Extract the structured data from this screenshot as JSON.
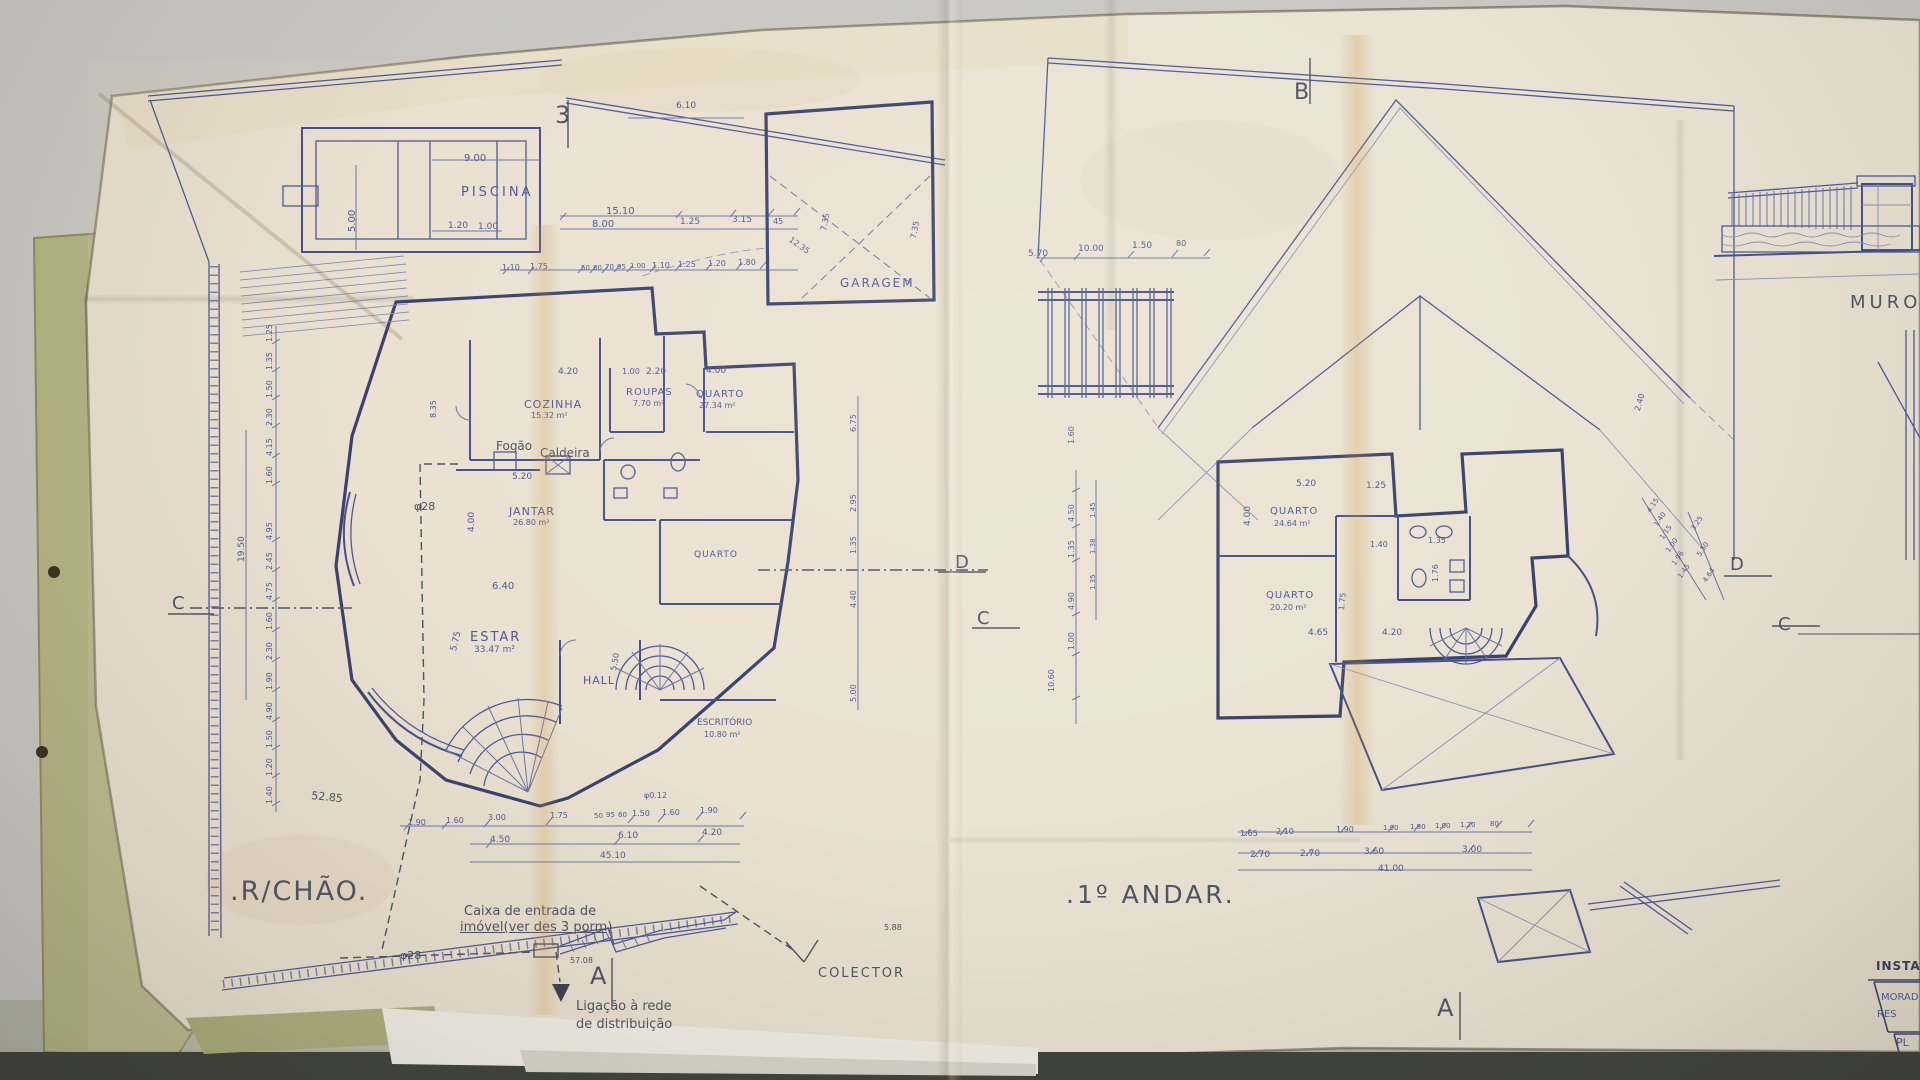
{
  "palette": {
    "desk": "#c9c8c3",
    "desk_low": "#b2b5a7",
    "shadow_band": "#3d4139",
    "paper": "#eae3d3",
    "fold_tan": "#c89137",
    "folder_green": "#b5b586",
    "ink": "#4d5a99",
    "ink_dark": "#39426f",
    "pencil": "#4e5366"
  },
  "left_plan": {
    "title": ".R/CHÃO."
  },
  "right_plan": {
    "title": ".1º ANDAR."
  },
  "labels": [
    {
      "n": "section-marker-3",
      "t": "3",
      "x": 555,
      "y": 103,
      "fs": 24,
      "cls": "pencil"
    },
    {
      "n": "piscina-label",
      "t": "PISCINA",
      "x": 461,
      "y": 186,
      "fs": 13,
      "ls": 3
    },
    {
      "t": "9.00",
      "x": 464,
      "y": 154,
      "fs": 10
    },
    {
      "t": "5.00",
      "x": 348,
      "y": 232,
      "fs": 10,
      "rot": -90
    },
    {
      "t": "1.20",
      "x": 448,
      "y": 222,
      "fs": 9
    },
    {
      "t": "1.00",
      "x": 478,
      "y": 223,
      "fs": 9
    },
    {
      "t": "15.10",
      "x": 606,
      "y": 207,
      "fs": 10
    },
    {
      "t": "8.00",
      "x": 592,
      "y": 220,
      "fs": 10
    },
    {
      "t": "1.25",
      "x": 680,
      "y": 218,
      "fs": 9
    },
    {
      "t": "3.15",
      "x": 732,
      "y": 216,
      "fs": 9
    },
    {
      "t": "45",
      "x": 773,
      "y": 218,
      "fs": 8
    },
    {
      "t": "6.10",
      "x": 676,
      "y": 102,
      "fs": 9
    },
    {
      "t": "1.10",
      "x": 502,
      "y": 264,
      "fs": 8
    },
    {
      "t": "1.75",
      "x": 530,
      "y": 263,
      "fs": 8
    },
    {
      "t": "50",
      "x": 581,
      "y": 265,
      "fs": 7
    },
    {
      "t": "80",
      "x": 593,
      "y": 265,
      "fs": 7
    },
    {
      "t": "70",
      "x": 605,
      "y": 264,
      "fs": 7
    },
    {
      "t": "95",
      "x": 617,
      "y": 264,
      "fs": 7
    },
    {
      "t": "1.00",
      "x": 630,
      "y": 263,
      "fs": 7
    },
    {
      "t": "1.10",
      "x": 652,
      "y": 262,
      "fs": 8
    },
    {
      "t": "1.25",
      "x": 678,
      "y": 261,
      "fs": 8
    },
    {
      "t": "1.20",
      "x": 708,
      "y": 260,
      "fs": 8
    },
    {
      "t": "1.80",
      "x": 738,
      "y": 259,
      "fs": 8
    },
    {
      "t": "12.35",
      "x": 792,
      "y": 236,
      "fs": 8,
      "rot": 35
    },
    {
      "t": "7.35",
      "x": 820,
      "y": 230,
      "fs": 8,
      "rot": -78
    },
    {
      "t": "7.35",
      "x": 910,
      "y": 238,
      "fs": 8,
      "rot": -80
    },
    {
      "n": "garagem-label",
      "t": "GARAGEM",
      "x": 840,
      "y": 277,
      "fs": 12,
      "ls": 2
    },
    {
      "t": "4.20",
      "x": 558,
      "y": 368,
      "fs": 9
    },
    {
      "t": "1.00",
      "x": 622,
      "y": 368,
      "fs": 8
    },
    {
      "t": "2.20",
      "x": 646,
      "y": 368,
      "fs": 9
    },
    {
      "t": "4.00",
      "x": 706,
      "y": 367,
      "fs": 9
    },
    {
      "n": "cozinha-label",
      "t": "COZINHA",
      "x": 524,
      "y": 399,
      "fs": 11,
      "ls": 1
    },
    {
      "n": "room-area",
      "t": "15.32 m²",
      "x": 531,
      "y": 412,
      "fs": 8
    },
    {
      "t": "8.35",
      "x": 430,
      "y": 418,
      "fs": 8,
      "rot": -90
    },
    {
      "n": "roupas-label",
      "t": "ROUPAS",
      "x": 626,
      "y": 388,
      "fs": 10,
      "ls": 1
    },
    {
      "n": "room-area",
      "t": "7.70 m²",
      "x": 633,
      "y": 400,
      "fs": 8
    },
    {
      "n": "quarto-label",
      "t": "QUARTO",
      "x": 696,
      "y": 390,
      "fs": 10,
      "ls": 1
    },
    {
      "n": "room-area",
      "t": "27.34 m²",
      "x": 699,
      "y": 402,
      "fs": 8
    },
    {
      "n": "fogao-label",
      "t": "Fogão",
      "x": 496,
      "y": 440,
      "fs": 12,
      "cls": "pencil"
    },
    {
      "n": "caldeira-label",
      "t": "Caldeira",
      "x": 540,
      "y": 447,
      "fs": 12,
      "cls": "pencil"
    },
    {
      "n": "phi28-label",
      "t": "φ28",
      "x": 414,
      "y": 501,
      "fs": 11,
      "cls": "pencil"
    },
    {
      "n": "jantar-label",
      "t": "JANTAR",
      "x": 509,
      "y": 506,
      "fs": 11,
      "ls": 1
    },
    {
      "n": "room-area",
      "t": "26.80 m²",
      "x": 513,
      "y": 519,
      "fs": 8
    },
    {
      "t": "5.20",
      "x": 512,
      "y": 473,
      "fs": 9
    },
    {
      "t": "4.00",
      "x": 468,
      "y": 532,
      "fs": 9,
      "rot": -90
    },
    {
      "n": "quarto2-label",
      "t": "QUARTO",
      "x": 694,
      "y": 551,
      "fs": 9,
      "ls": 1
    },
    {
      "t": "6.40",
      "x": 492,
      "y": 582,
      "fs": 10
    },
    {
      "n": "estar-label",
      "t": "ESTAR",
      "x": 470,
      "y": 631,
      "fs": 13,
      "ls": 2
    },
    {
      "n": "room-area",
      "t": "33.47 m²",
      "x": 474,
      "y": 646,
      "fs": 9
    },
    {
      "t": "5.75",
      "x": 450,
      "y": 650,
      "fs": 9,
      "rot": -76
    },
    {
      "t": "5.50",
      "x": 610,
      "y": 670,
      "fs": 8,
      "rot": -80
    },
    {
      "n": "hall-label",
      "t": "HALL",
      "x": 583,
      "y": 675,
      "fs": 11,
      "ls": 1
    },
    {
      "n": "escritorio-label",
      "t": "ESCRITÓRIO",
      "x": 697,
      "y": 719,
      "fs": 9
    },
    {
      "n": "room-area",
      "t": "10.80 m²",
      "x": 704,
      "y": 731,
      "fs": 8
    },
    {
      "t": "1.25",
      "x": 266,
      "y": 342,
      "fs": 8,
      "rot": -90
    },
    {
      "t": "1.35",
      "x": 266,
      "y": 370,
      "fs": 8,
      "rot": -90
    },
    {
      "t": "1.50",
      "x": 266,
      "y": 398,
      "fs": 8,
      "rot": -90
    },
    {
      "t": "2.30",
      "x": 266,
      "y": 426,
      "fs": 8,
      "rot": -90
    },
    {
      "t": "4.15",
      "x": 266,
      "y": 456,
      "fs": 8,
      "rot": -90
    },
    {
      "t": "1.60",
      "x": 266,
      "y": 484,
      "fs": 8,
      "rot": -90
    },
    {
      "t": "4.95",
      "x": 266,
      "y": 540,
      "fs": 8,
      "rot": -90
    },
    {
      "t": "2.45",
      "x": 266,
      "y": 570,
      "fs": 8,
      "rot": -90
    },
    {
      "t": "4.75",
      "x": 266,
      "y": 600,
      "fs": 8,
      "rot": -90
    },
    {
      "t": "1.60",
      "x": 266,
      "y": 630,
      "fs": 8,
      "rot": -90
    },
    {
      "t": "2.30",
      "x": 266,
      "y": 660,
      "fs": 8,
      "rot": -90
    },
    {
      "t": "1.90",
      "x": 266,
      "y": 690,
      "fs": 8,
      "rot": -90
    },
    {
      "t": "4.90",
      "x": 266,
      "y": 720,
      "fs": 8,
      "rot": -90
    },
    {
      "t": "1.50",
      "x": 266,
      "y": 748,
      "fs": 8,
      "rot": -90
    },
    {
      "t": "1.20",
      "x": 266,
      "y": 776,
      "fs": 8,
      "rot": -90
    },
    {
      "t": "1.40",
      "x": 266,
      "y": 804,
      "fs": 8,
      "rot": -90
    },
    {
      "t": "19.50",
      "x": 238,
      "y": 562,
      "fs": 9,
      "rot": -90
    },
    {
      "t": "6.75",
      "x": 850,
      "y": 432,
      "fs": 8,
      "rot": -90
    },
    {
      "t": "2.95",
      "x": 850,
      "y": 512,
      "fs": 8,
      "rot": -90
    },
    {
      "t": "1.35",
      "x": 850,
      "y": 554,
      "fs": 8,
      "rot": -90
    },
    {
      "t": "4.40",
      "x": 850,
      "y": 608,
      "fs": 8,
      "rot": -90
    },
    {
      "t": "5.00",
      "x": 850,
      "y": 702,
      "fs": 8,
      "rot": -90
    },
    {
      "t": "52.85",
      "x": 312,
      "y": 790,
      "fs": 11,
      "rot": 6,
      "cls": "pencil"
    },
    {
      "t": "1.90",
      "x": 408,
      "y": 819,
      "fs": 8
    },
    {
      "t": "1.60",
      "x": 446,
      "y": 817,
      "fs": 8
    },
    {
      "t": "3.00",
      "x": 488,
      "y": 814,
      "fs": 8
    },
    {
      "t": "1.75",
      "x": 550,
      "y": 812,
      "fs": 8
    },
    {
      "t": "50",
      "x": 594,
      "y": 813,
      "fs": 7
    },
    {
      "t": "95",
      "x": 606,
      "y": 812,
      "fs": 7
    },
    {
      "t": "60",
      "x": 618,
      "y": 812,
      "fs": 7
    },
    {
      "t": "1.50",
      "x": 632,
      "y": 810,
      "fs": 8
    },
    {
      "t": "1.60",
      "x": 662,
      "y": 809,
      "fs": 8
    },
    {
      "t": "1.90",
      "x": 700,
      "y": 807,
      "fs": 8
    },
    {
      "t": "4.50",
      "x": 490,
      "y": 836,
      "fs": 9
    },
    {
      "t": "6.10",
      "x": 618,
      "y": 832,
      "fs": 9
    },
    {
      "t": "4.20",
      "x": 702,
      "y": 829,
      "fs": 9
    },
    {
      "t": "45.10",
      "x": 600,
      "y": 852,
      "fs": 9
    },
    {
      "t": "φ0.12",
      "x": 644,
      "y": 792,
      "fs": 8
    },
    {
      "n": "caixa-note-line1",
      "t": "Caixa de entrada de",
      "x": 464,
      "y": 905,
      "fs": 13,
      "cls": "pencil"
    },
    {
      "n": "caixa-note-line2",
      "t": "imóvel(ver des 3 porm)",
      "x": 460,
      "y": 921,
      "fs": 13,
      "cls": "pencil",
      "u": 1
    },
    {
      "n": "phi28-label",
      "t": "φ28",
      "x": 400,
      "y": 950,
      "fs": 11,
      "cls": "pencil"
    },
    {
      "t": "57.08",
      "x": 570,
      "y": 957,
      "fs": 8,
      "cls": "pencil"
    },
    {
      "n": "section-marker-A",
      "t": "A",
      "x": 590,
      "y": 964,
      "fs": 24,
      "cls": "pencil"
    },
    {
      "n": "ligacao-note-line1",
      "t": "Ligação à rede",
      "x": 576,
      "y": 1000,
      "fs": 13,
      "cls": "pencil"
    },
    {
      "n": "ligacao-note-line2",
      "t": "de distribuição",
      "x": 576,
      "y": 1018,
      "fs": 13,
      "cls": "pencil"
    },
    {
      "n": "colector-label",
      "t": "COLECTOR",
      "x": 818,
      "y": 967,
      "fs": 13,
      "ls": 2,
      "cls": "pencil"
    },
    {
      "t": "5.88",
      "x": 884,
      "y": 924,
      "fs": 8,
      "cls": "pencil"
    },
    {
      "n": "section-marker-C",
      "t": "C",
      "x": 172,
      "y": 595,
      "fs": 18,
      "cls": "pencil"
    },
    {
      "n": "section-marker-D",
      "t": "D",
      "x": 955,
      "y": 554,
      "fs": 18,
      "cls": "pencil"
    },
    {
      "n": "section-marker-B",
      "t": "B",
      "x": 1294,
      "y": 82,
      "fs": 22,
      "cls": "pencil"
    },
    {
      "t": "5.70",
      "x": 1028,
      "y": 250,
      "fs": 9
    },
    {
      "t": "10.00",
      "x": 1078,
      "y": 245,
      "fs": 9
    },
    {
      "t": "1.50",
      "x": 1132,
      "y": 242,
      "fs": 9
    },
    {
      "t": "80",
      "x": 1176,
      "y": 240,
      "fs": 8
    },
    {
      "t": "1.60",
      "x": 1068,
      "y": 444,
      "fs": 8,
      "rot": -90
    },
    {
      "t": "4.50",
      "x": 1068,
      "y": 522,
      "fs": 8,
      "rot": -90
    },
    {
      "t": "1.35",
      "x": 1068,
      "y": 558,
      "fs": 8,
      "rot": -90
    },
    {
      "t": "4.90",
      "x": 1068,
      "y": 610,
      "fs": 8,
      "rot": -90
    },
    {
      "t": "1.00",
      "x": 1068,
      "y": 650,
      "fs": 8,
      "rot": -90
    },
    {
      "t": "10.60",
      "x": 1048,
      "y": 692,
      "fs": 8,
      "rot": -90
    },
    {
      "t": "1.45",
      "x": 1090,
      "y": 518,
      "fs": 7,
      "rot": -90
    },
    {
      "t": "1.38",
      "x": 1090,
      "y": 554,
      "fs": 7,
      "rot": -90
    },
    {
      "t": "1.35",
      "x": 1090,
      "y": 590,
      "fs": 7,
      "rot": -90
    },
    {
      "t": "5.20",
      "x": 1296,
      "y": 480,
      "fs": 9
    },
    {
      "t": "1.25",
      "x": 1366,
      "y": 482,
      "fs": 9
    },
    {
      "t": "4.00",
      "x": 1244,
      "y": 526,
      "fs": 9,
      "rot": -90
    },
    {
      "n": "quarto-label",
      "t": "QUARTO",
      "x": 1270,
      "y": 507,
      "fs": 10,
      "ls": 1
    },
    {
      "n": "room-area",
      "t": "24.64 m²",
      "x": 1274,
      "y": 520,
      "fs": 8
    },
    {
      "t": "1.40",
      "x": 1370,
      "y": 541,
      "fs": 8
    },
    {
      "t": "1.35",
      "x": 1428,
      "y": 537,
      "fs": 8
    },
    {
      "n": "quarto-label",
      "t": "QUARTO",
      "x": 1266,
      "y": 591,
      "fs": 10,
      "ls": 1
    },
    {
      "n": "room-area",
      "t": "20.20 m²",
      "x": 1270,
      "y": 604,
      "fs": 8
    },
    {
      "t": "1.76",
      "x": 1432,
      "y": 582,
      "fs": 8,
      "rot": -90
    },
    {
      "t": "1.75",
      "x": 1338,
      "y": 610,
      "fs": 8,
      "rot": -84
    },
    {
      "t": "4.65",
      "x": 1308,
      "y": 629,
      "fs": 9
    },
    {
      "t": "4.20",
      "x": 1382,
      "y": 629,
      "fs": 9
    },
    {
      "t": "2.40",
      "x": 1634,
      "y": 410,
      "fs": 8,
      "rot": -75
    },
    {
      "t": "4.15",
      "x": 1646,
      "y": 510,
      "fs": 7,
      "rot": -55
    },
    {
      "t": "1.40",
      "x": 1653,
      "y": 524,
      "fs": 7,
      "rot": -55
    },
    {
      "t": "1.15",
      "x": 1659,
      "y": 537,
      "fs": 7,
      "rot": -55
    },
    {
      "t": "1.00",
      "x": 1665,
      "y": 550,
      "fs": 7,
      "rot": -55
    },
    {
      "t": "1.96",
      "x": 1671,
      "y": 563,
      "fs": 7,
      "rot": -55
    },
    {
      "t": "1.45",
      "x": 1677,
      "y": 576,
      "fs": 7,
      "rot": -55
    },
    {
      "t": "3.25",
      "x": 1690,
      "y": 528,
      "fs": 7,
      "rot": -55
    },
    {
      "t": "5.50",
      "x": 1696,
      "y": 554,
      "fs": 7,
      "rot": -55
    },
    {
      "t": "4.64",
      "x": 1702,
      "y": 580,
      "fs": 7,
      "rot": -55
    },
    {
      "t": "1.65",
      "x": 1240,
      "y": 830,
      "fs": 8
    },
    {
      "t": "2.10",
      "x": 1276,
      "y": 828,
      "fs": 8
    },
    {
      "t": "1.90",
      "x": 1336,
      "y": 826,
      "fs": 8
    },
    {
      "t": "1.90",
      "x": 1383,
      "y": 825,
      "fs": 7
    },
    {
      "t": "1.80",
      "x": 1410,
      "y": 824,
      "fs": 7
    },
    {
      "t": "1.00",
      "x": 1435,
      "y": 823,
      "fs": 7
    },
    {
      "t": "1.20",
      "x": 1460,
      "y": 822,
      "fs": 7
    },
    {
      "t": "80",
      "x": 1490,
      "y": 821,
      "fs": 7
    },
    {
      "t": "2.70",
      "x": 1250,
      "y": 851,
      "fs": 9
    },
    {
      "t": "2.70",
      "x": 1300,
      "y": 850,
      "fs": 9
    },
    {
      "t": "3.60",
      "x": 1364,
      "y": 848,
      "fs": 9
    },
    {
      "t": "3.00",
      "x": 1462,
      "y": 846,
      "fs": 9
    },
    {
      "t": "41.00",
      "x": 1378,
      "y": 865,
      "fs": 9
    },
    {
      "n": "section-marker-A",
      "t": "A",
      "x": 1437,
      "y": 996,
      "fs": 24,
      "cls": "pencil"
    },
    {
      "n": "section-marker-C",
      "t": "C",
      "x": 977,
      "y": 610,
      "fs": 18,
      "cls": "pencil"
    },
    {
      "n": "section-marker-D",
      "t": "D",
      "x": 1730,
      "y": 556,
      "fs": 18,
      "cls": "pencil"
    },
    {
      "n": "muro-label",
      "t": "MURO",
      "x": 1850,
      "y": 294,
      "fs": 18,
      "ls": 4,
      "cls": "pencil"
    },
    {
      "n": "section-marker-C",
      "t": "C",
      "x": 1778,
      "y": 616,
      "fs": 18,
      "cls": "pencil"
    },
    {
      "n": "titleblock-heading",
      "t": "INSTAL",
      "x": 1876,
      "y": 960,
      "fs": 12,
      "ls": 1,
      "cls": "dark"
    },
    {
      "n": "titleblock-row1",
      "t": "MORAD",
      "x": 1881,
      "y": 993,
      "fs": 10
    },
    {
      "n": "titleblock-row2",
      "t": "RES",
      "x": 1877,
      "y": 1010,
      "fs": 10
    },
    {
      "n": "titleblock-row3",
      "t": "PL",
      "x": 1896,
      "y": 1037,
      "fs": 11
    }
  ]
}
